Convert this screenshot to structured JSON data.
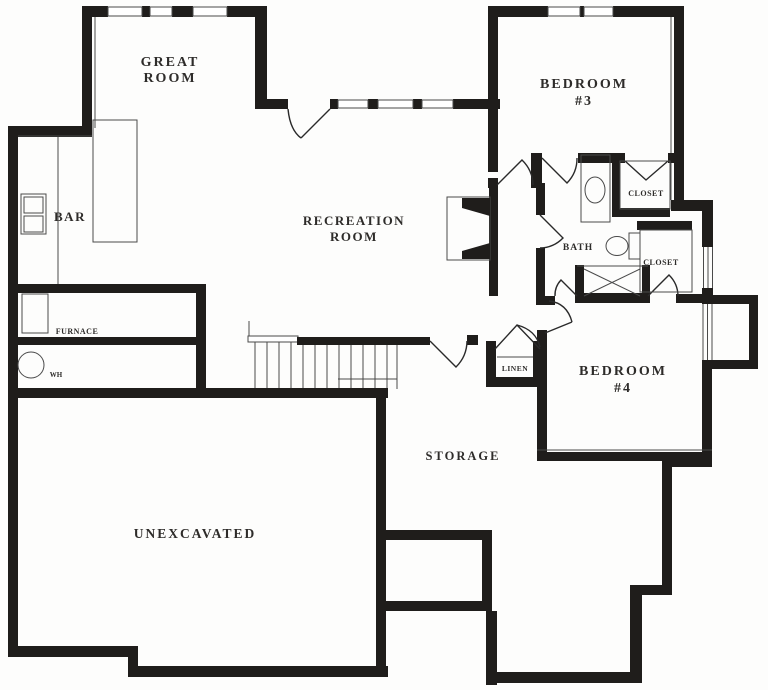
{
  "plan": {
    "labels": {
      "great_room_line1": "GREAT",
      "great_room_line2": "ROOM",
      "recreation_line1": "RECREATION",
      "recreation_line2": "ROOM",
      "bedroom3_line1": "BEDROOM",
      "bedroom3_line2": "#3",
      "bedroom4_line1": "BEDROOM",
      "bedroom4_line2": "#4",
      "bar": "BAR",
      "bath": "BATH",
      "closet_bed3": "CLOSET",
      "closet_bed4": "CLOSET",
      "linen": "LINEN",
      "furnace": "FURNACE",
      "water_heater": "WH",
      "storage": "STORAGE",
      "unexcavated": "UNEXCAVATED"
    },
    "colors": {
      "wall": "#1f1d1b",
      "thin_line": "#4a4a4a",
      "background": "#fdfdfc",
      "label": "#2e2c2a"
    }
  }
}
